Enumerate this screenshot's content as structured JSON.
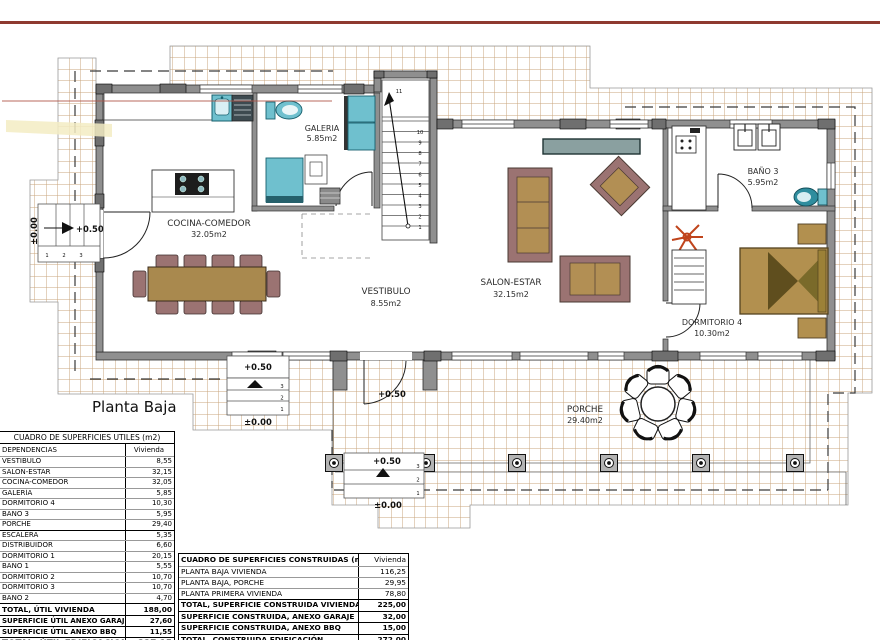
{
  "meta": {
    "plan_title": "Planta Baja"
  },
  "plan": {
    "rooms": {
      "galeria": {
        "name": "GALERIA",
        "area": "5.85m2"
      },
      "cocina": {
        "name": "COCINA-COMEDOR",
        "area": "32.05m2"
      },
      "vestibulo": {
        "name": "VESTIBULO",
        "area": "8.55m2"
      },
      "salon": {
        "name": "SALON-ESTAR",
        "area": "32.15m2"
      },
      "bano3": {
        "name": "BAÑO 3",
        "area": "5.95m2"
      },
      "dormitorio4": {
        "name": "DORMITORIO 4",
        "area": "10.30m2"
      },
      "porche": {
        "name": "PORCHE",
        "area": "29.40m2"
      }
    },
    "levels": {
      "left_up": "+0.50",
      "left_base": "±0.00",
      "rear_up": "+0.50",
      "rear_base": "±0.00",
      "entry_landing": "+0.50",
      "entry_up": "+0.50",
      "entry_base": "±0.00"
    },
    "stairs": {
      "main": [
        "1",
        "2",
        "3",
        "4",
        "5",
        "6",
        "7",
        "8",
        "9",
        "10",
        "11"
      ],
      "rear": [
        "3",
        "2",
        "1"
      ],
      "front": [
        "3",
        "2",
        "1"
      ],
      "left": [
        "1",
        "2",
        "3"
      ]
    }
  },
  "tables": {
    "utiles": {
      "title": "CUADRO DE SUPERFICIES UTILES (m2)",
      "col_label": "DEPENDENCIAS",
      "col_value": "Vivienda",
      "rows": [
        [
          "VESTIBULO",
          "8,55"
        ],
        [
          "SALON-ESTAR",
          "32,15"
        ],
        [
          "COCINA-COMEDOR",
          "32,05"
        ],
        [
          "GALERÍA",
          "5,85"
        ],
        [
          "DORMITORIO 4",
          "10,30"
        ],
        [
          "BAÑO 3",
          "5,95"
        ],
        [
          "PORCHE",
          "29,40"
        ],
        [
          "ESCALERA",
          "5,35"
        ],
        [
          "DISTRIBUIDOR",
          "6,60"
        ],
        [
          "DORMITORIO 1",
          "20,15"
        ],
        [
          "BAÑO 1",
          "5,55"
        ],
        [
          "DORMITORIO 2",
          "10,70"
        ],
        [
          "DORMITORIO 3",
          "10,70"
        ],
        [
          "BAÑO 2",
          "4,70"
        ]
      ],
      "totals": {
        "vivienda": {
          "label": "TOTAL, ÚTIL VIVIENDA",
          "value": "188,00"
        },
        "garaje": {
          "label": "SUPERFICIE ÚTIL ANEXO GARAJE",
          "value": "27,60"
        },
        "bbq": {
          "label": "SUPERFICIE ÚTIL ANEXO BBQ",
          "value": "11,55"
        },
        "edificacion": {
          "label": "TOTAL, ÚTIL EDIFICACION",
          "value": "227,15"
        }
      }
    },
    "construidas": {
      "title": "CUADRO DE SUPERFICIES CONSTRUIDAS (m2)",
      "col_value": "Vivienda",
      "rows": [
        [
          "PLANTA BAJA VIVIENDA",
          "116,25"
        ],
        [
          "PLANTA BAJA, PORCHE",
          "29,95"
        ],
        [
          "PLANTA PRIMERA VIVIENDA",
          "78,80"
        ]
      ],
      "totals": {
        "vivienda": {
          "label": "TOTAL, SUPERFICIE CONSTRUIDA VIVIENDA",
          "value": "225,00"
        },
        "garaje": {
          "label": "SUPERFICIE CONSTRUIDA, ANEXO GARAJE",
          "value": "32,00"
        },
        "bbq": {
          "label": "SUPERFICIE CONSTRUIDA, ANEXO BBQ",
          "value": "15,00"
        },
        "edificacion": {
          "label": "TOTAL, CONSTRUIDA EDIFICACIÓN",
          "value": "272,00"
        }
      }
    }
  },
  "colors": {
    "accent_red": "#8e3a30",
    "tile_line": "#c9a67c",
    "teal": "#6fc0ce",
    "wood": "#b2904f",
    "mauve": "#9b7372"
  }
}
